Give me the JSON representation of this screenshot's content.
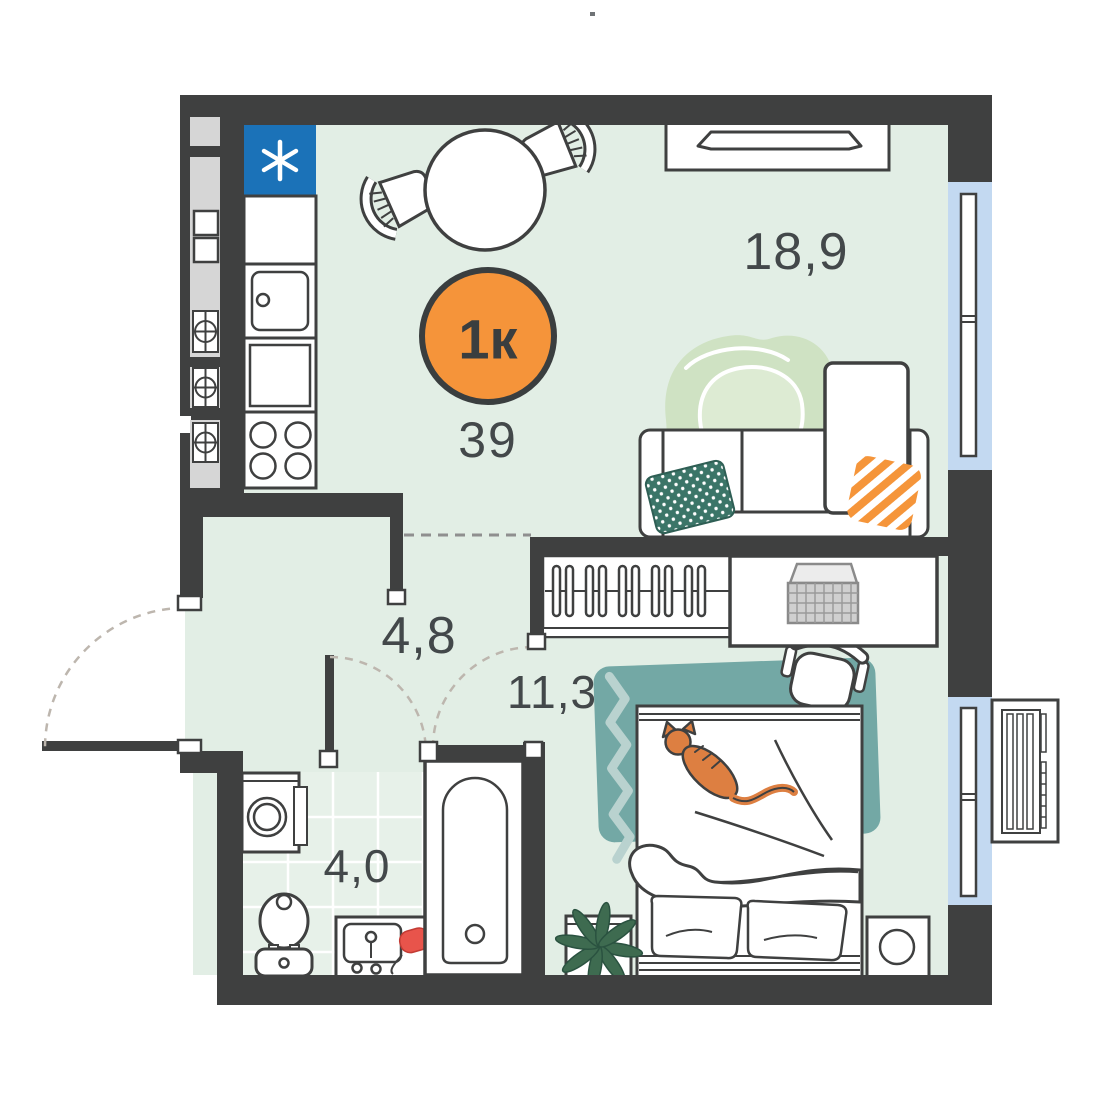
{
  "badge": {
    "unit": "1к",
    "area": "39"
  },
  "rooms": {
    "living": {
      "label": "18,9"
    },
    "bedroom": {
      "label": "11,3"
    },
    "hallway": {
      "label": "4,8"
    },
    "bathroom": {
      "label": "4,0"
    }
  },
  "kitchen": {
    "fridge_symbol": "*"
  },
  "icons": {
    "fridge": "snowflake-asterisk-icon",
    "vent_shaft": "circle-cross-duct-icon",
    "desk_device": "laptop-icon"
  },
  "colors": {
    "wall": "#3f4040",
    "floor": "#e2eee5",
    "tile_grid": "#ffffff",
    "shaft_gray": "#d6d6d6",
    "fridge_blue": "#1b72b8",
    "window_blue": "#c3d9f1",
    "badge_orange": "#f5943a",
    "rug_living": "#cfe2c3",
    "rug_bedroom": "#73a8a5",
    "rug_zigzag": "#b9d2cf",
    "pillow_teal": "#3b7568",
    "pillow_stripe_orange": "#f5953a",
    "cat_orange": "#dd7f41",
    "plant_green": "#3e6b50",
    "pot_red": "#9e4a3c",
    "hairdryer_red": "#e8544b",
    "label_gray": "#43484a"
  }
}
